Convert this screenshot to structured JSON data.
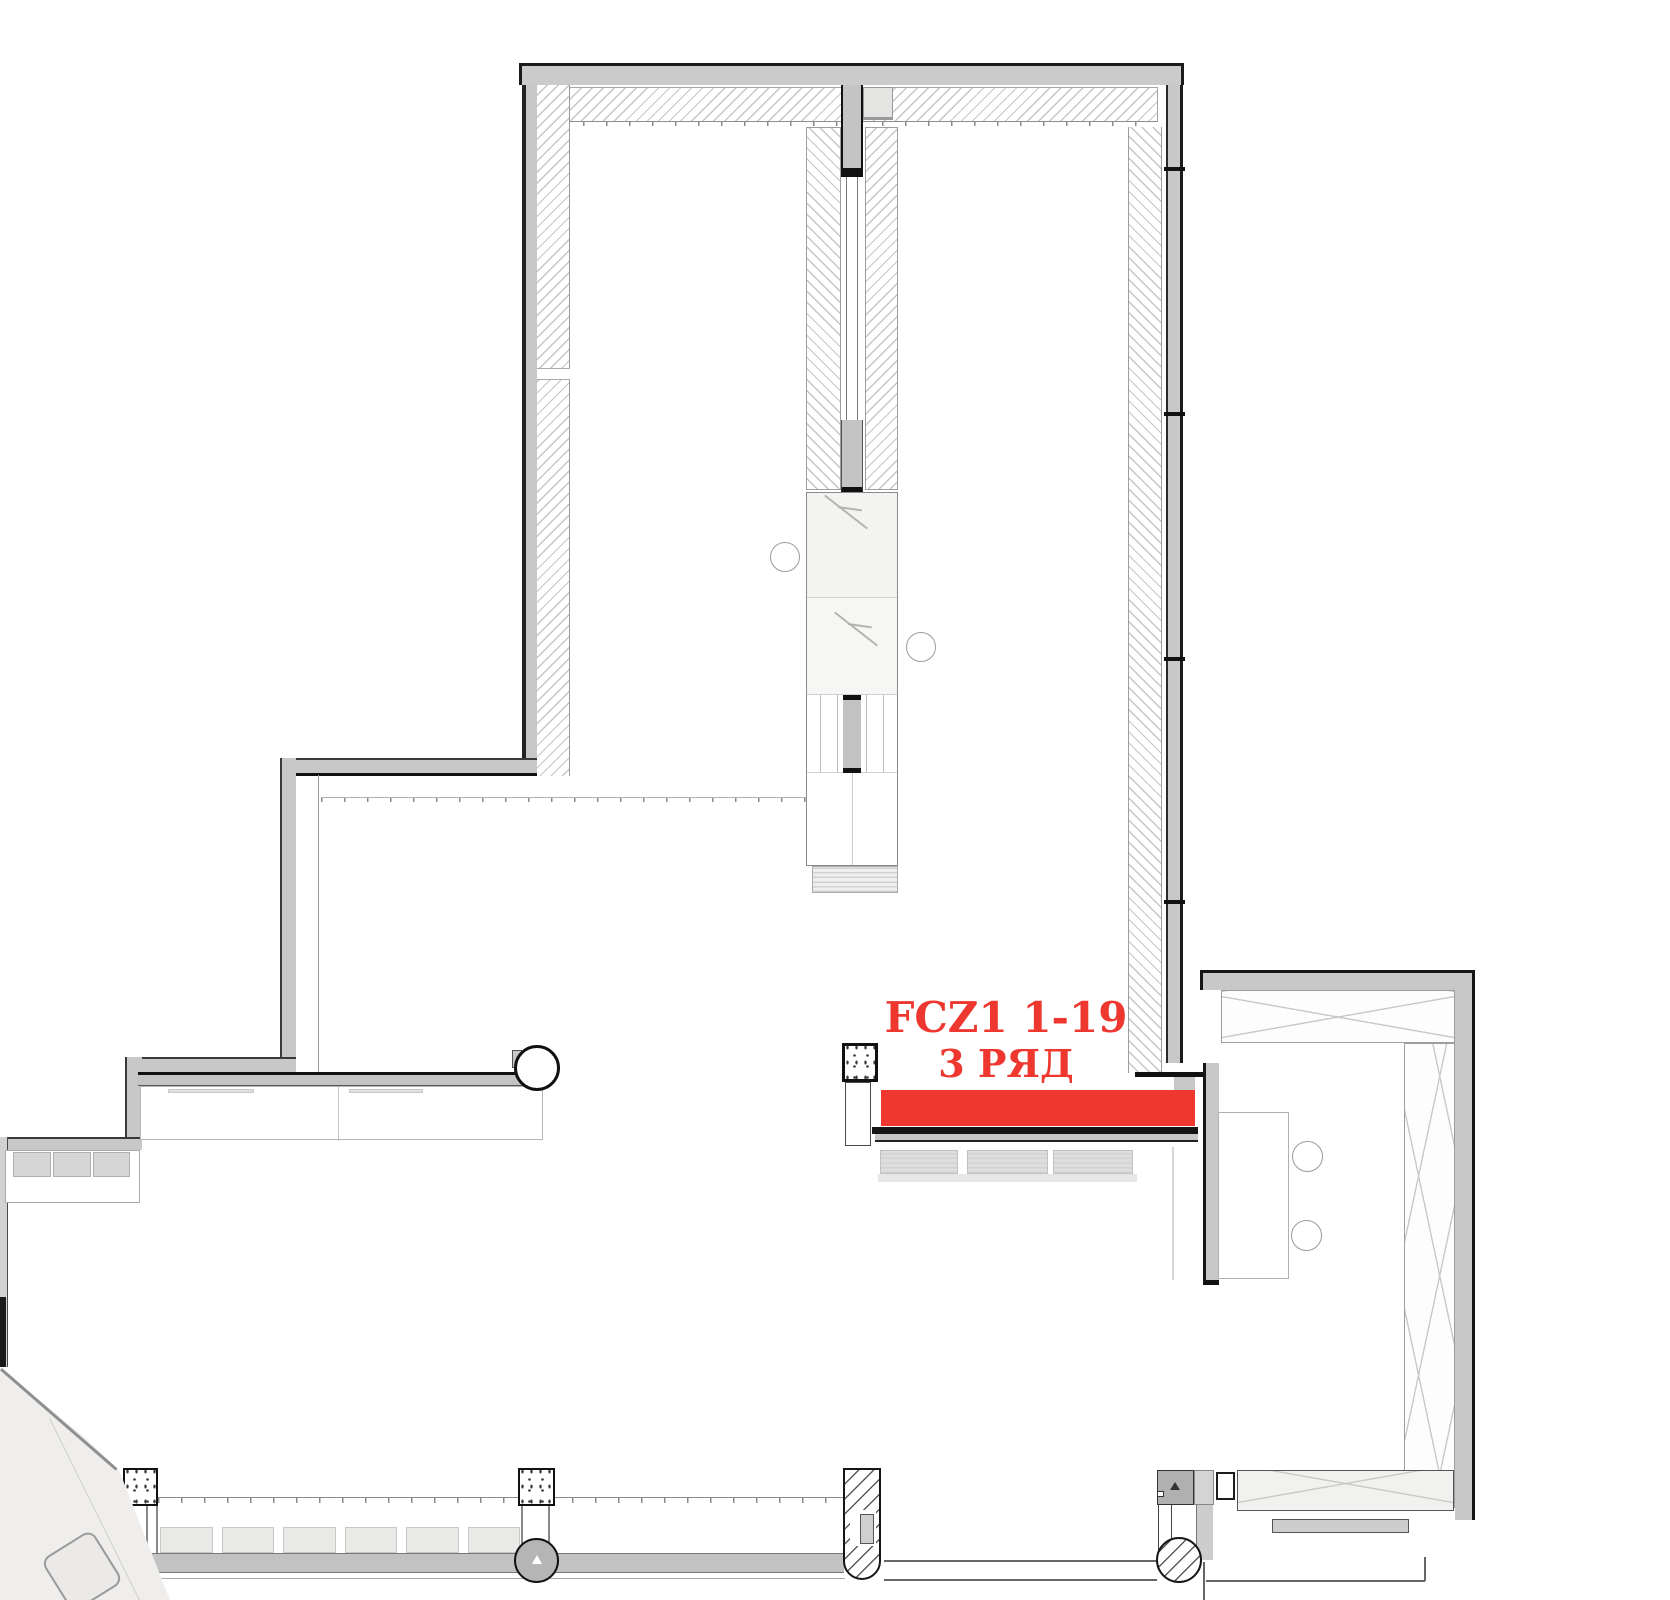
{
  "zone": {
    "code": "FCZ1 1-19",
    "row": "3 РЯД",
    "highlight_color": "#ee372e"
  },
  "palette": {
    "wall_fill": "#c8c8c8",
    "wall_dark": "#161616",
    "thin_line": "#8f8f8f",
    "hatch_line": "#c6c6c6",
    "floor": "#ffffff"
  }
}
